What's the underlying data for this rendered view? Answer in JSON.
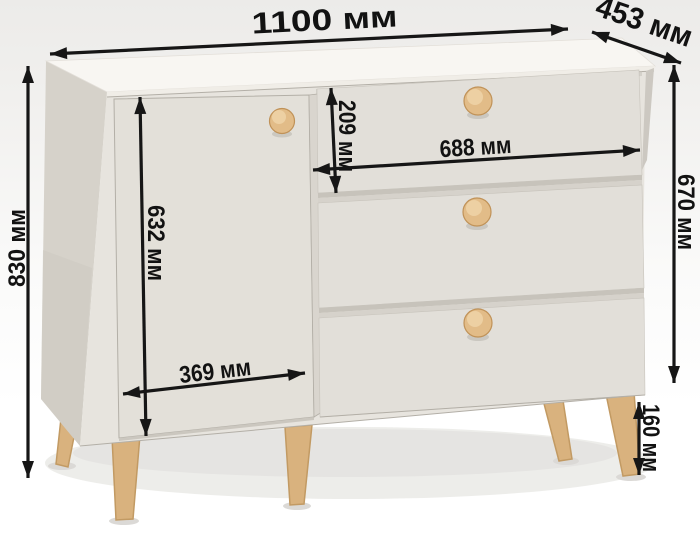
{
  "colors": {
    "dimension_line": "#161616",
    "cabinet_top": "#f8f6f2",
    "cabinet_front": "#e7e4de",
    "cabinet_side": "#d6d2ca",
    "door": "#e3e0d9",
    "drawer": "#e2dfd9",
    "knob_wood": "#e2bc88",
    "leg_wood": "#d9b27e"
  },
  "dimensions": {
    "width": {
      "label": "1100 мм",
      "value": 1100
    },
    "depth": {
      "label": "453 мм",
      "value": 453
    },
    "total_height": {
      "label": "830 мм",
      "value": 830
    },
    "body_height": {
      "label": "670 мм",
      "value": 670
    },
    "top_drawer_height": {
      "label": "209 мм",
      "value": 209
    },
    "drawer_width": {
      "label": "688 мм",
      "value": 688
    },
    "door_height": {
      "label": "632 мм",
      "value": 632
    },
    "door_width": {
      "label": "369 мм",
      "value": 369
    },
    "leg_height": {
      "label": "160 мм",
      "value": 160
    }
  }
}
